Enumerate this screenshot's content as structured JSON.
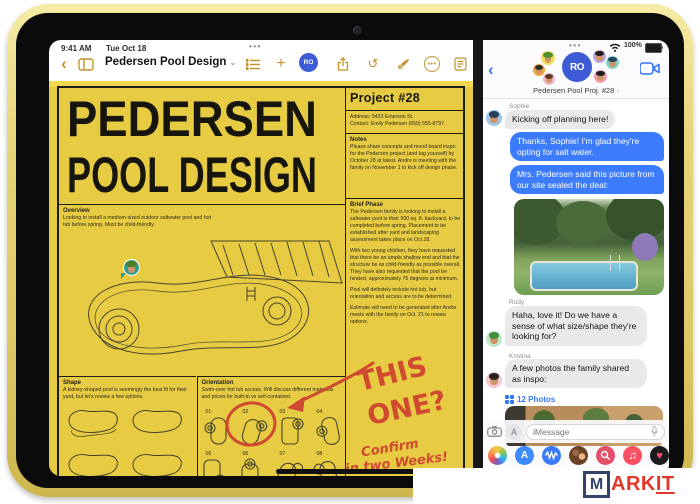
{
  "status": {
    "time": "9:41 AM",
    "date": "Tue Oct 18",
    "battery_pct": "100%",
    "pane_menu": "•••"
  },
  "freeform": {
    "title": "Pedersen Pool Design",
    "doc": {
      "title1": "PEDERSEN",
      "title2": "POOL DESIGN",
      "project_title": "Project #28",
      "address": "Address: 5433 Emerson St.",
      "contact": "Contact: Emily Pedersen (650) 555-8797",
      "notes_label": "Notes",
      "notes_text": "Please share concepts and mood board inspo for the Pedersen project (and tag yourself) by October 28 at latest. Andre is meeting with the family on November 1 to kick off design phase.",
      "overview_label": "Overview",
      "overview_text": "Looking to install a medium-sized outdoor saltwater pool and hot tub before spring. Must be child-friendly.",
      "brief_label": "Brief Phase",
      "brief_p1": "The Pedersen family is looking to install a saltwater pool in their 500 sq. ft. backyard, to be completed before spring. Placement to be established after yard and landscaping assessment takes place on Oct.18.",
      "brief_p2": "With two young children, they have requested that there be an ample shallow end and that the structure be as child-friendly as possible overall. They have also requested that the pool be heated, approximately 75 degrees at minimum.",
      "brief_p3": "Pool will definitely include hot tub, but orientation and access are to be determined.",
      "brief_p4": "Estimate will need to be generated after Andre meets with the family on Oct. 21 to review options.",
      "shape_label": "Shape",
      "shape_text": "A kidney-shaped pool is seemingly the best fit for their yard, but let's review a few options.",
      "orientation_label": "Orientation",
      "orientation_text": "Swim-over hot tub access. Will discuss different materials and prices for built-in vs self-contained.",
      "diagram_numbers": [
        "01",
        "02",
        "03",
        "04",
        "05",
        "06",
        "07",
        "08"
      ],
      "ink_this": "THIS",
      "ink_one": "ONE?",
      "ink_confirm": "Confirm",
      "ink_weeks": "in two Weeks!"
    }
  },
  "messages": {
    "group_name": "Pedersen Pool Proj. #28",
    "logo_monogram": "RO",
    "items": [
      {
        "sender": "Sophie",
        "text": "Kicking off planning here!"
      },
      {
        "text": "Thanks, Sophie! I'm glad they're opting for salt water."
      },
      {
        "text": "Mrs. Pedersen said this picture from our site sealed the deal:"
      },
      {
        "sender": "Rody",
        "text": "Haha, love it! Do we have a sense of what size/shape they're looking for?"
      },
      {
        "sender": "Kristina",
        "text": "A few photos the family shared as inspo:"
      }
    ],
    "photos_link": "12 Photos",
    "input_placeholder": "iMessage"
  },
  "watermark": {
    "m": "M",
    "ark": "ARK",
    "it": "IT"
  },
  "colors": {
    "accent_blue": "#3478f6",
    "bubble_blue": "#3d7bfd",
    "bubble_gray": "#e9e9eb",
    "doc_yellow": "#e7cb42",
    "toolbar_gold": "#c2922e",
    "marker_red": "#cf4a31"
  }
}
